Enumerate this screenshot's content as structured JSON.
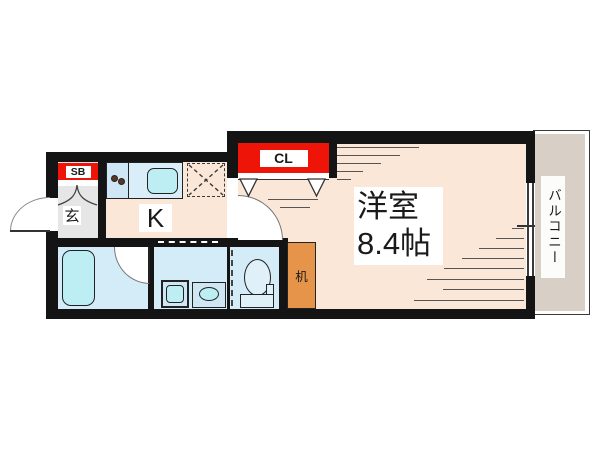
{
  "labels": {
    "closet": "CL",
    "shoe_box": "SB",
    "entrance": "玄",
    "kitchen": "K",
    "room_name": "洋室",
    "room_size": "8.4帖",
    "desk": "机",
    "balcony": "バルコニー"
  },
  "colors": {
    "wall": "#141414",
    "room_floor": "#fae7d7",
    "wet_floor": "#d3ecf8",
    "fixture_fill": "#bdeef4",
    "unit_fill": "#cfe6f4",
    "genkan_floor": "#e6e6e6",
    "balcony_fill": "#d8d0c7",
    "label_red": "#ee1408",
    "desk_fill": "#e5944a"
  }
}
